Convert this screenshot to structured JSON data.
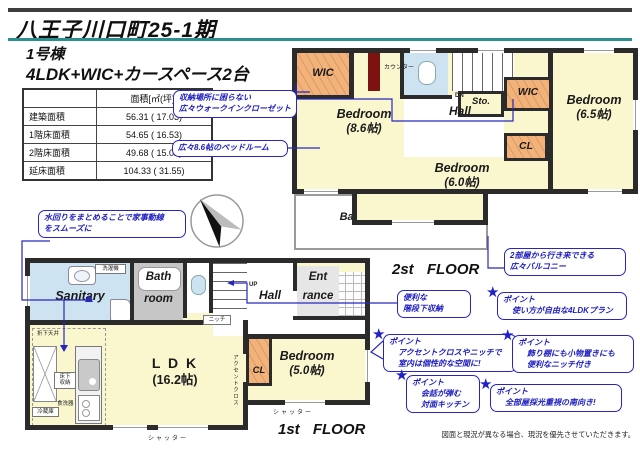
{
  "page": {
    "title": "八王子川口町25-1期",
    "unit": "1号棟",
    "spec": "4LDK+WIC+カースペース2台",
    "disclaimer": "図面と現況が異なる場合、現況を優先させていただきます。"
  },
  "area_table": {
    "corner": "",
    "header": "面積[㎡(坪)]",
    "rows": [
      {
        "label": "建築面積",
        "value": "56.31 ( 17.03)"
      },
      {
        "label": "1階床面積",
        "value": "54.65 ( 16.53)"
      },
      {
        "label": "2階床面積",
        "value": "49.68 ( 15.02)"
      },
      {
        "label": "延床面積",
        "value": "104.33 ( 31.55)"
      }
    ]
  },
  "floor2": {
    "floor_label": "2st FLOOR",
    "rooms": {
      "wic_left": "WIC",
      "wic_right": "WIC",
      "storage": "Sto.",
      "closet": "CL",
      "hall": "Hall",
      "balcony": "Balcony",
      "bedroom_86": {
        "name": "Bedroom",
        "size": "(8.6帖)"
      },
      "bedroom_60": {
        "name": "Bedroom",
        "size": "(6.0帖)"
      },
      "bedroom_65": {
        "name": "Bedroom",
        "size": "(6.5帖)"
      }
    },
    "labels": {
      "counter": "カウンター",
      "down": "DN"
    }
  },
  "floor1": {
    "floor_label": "1st FLOOR",
    "rooms": {
      "sanitary": "Sanitary",
      "bath": {
        "line1": "Bath",
        "line2": "room"
      },
      "hall": "Hall",
      "entrance": {
        "line1": "Ent",
        "line2": "rance"
      },
      "closet": "CL",
      "ldk": {
        "name": "L D K",
        "size": "(16.2帖)"
      },
      "bedroom_50": {
        "name": "Bedroom",
        "size": "(5.0帖)"
      }
    },
    "labels": {
      "washer": "洗濯機",
      "up": "UP",
      "niche": "ニッチ",
      "dropped_ceiling": "折下天井",
      "floor_storage_1": "床下",
      "floor_storage_2": "収納",
      "dishwasher": "食洗器",
      "fridge": "冷蔵庫",
      "accent_cloth": "アクセントクロス",
      "shutter": "シャッター"
    }
  },
  "callouts": [
    {
      "lines": [
        "収納場所に困らない",
        "広々ウォークインクローゼット"
      ]
    },
    {
      "lines": [
        "広々8.6帖のベッドルーム"
      ]
    },
    {
      "lines": [
        "水回りをまとめることで家事動線",
        "をスムーズに"
      ]
    },
    {
      "lines": [
        "2部屋から行き来できる",
        "広々バルコニー"
      ]
    },
    {
      "lines": [
        "便利な",
        "階段下収納"
      ]
    },
    {
      "lines": [
        "ポイント",
        "使い方が自由な4LDKプラン"
      ]
    },
    {
      "lines": [
        "ポイント",
        "アクセントクロスやニッチで",
        "室内は個性的な空間に!"
      ]
    },
    {
      "lines": [
        "ポイント",
        "飾り棚にも小物置きにも",
        "便利なニッチ付き"
      ]
    },
    {
      "lines": [
        "ポイント",
        "会話が弾む",
        "対面キッチン"
      ]
    },
    {
      "lines": [
        "ポイント",
        "全部屋採光重視の南向き!"
      ]
    }
  ],
  "icons": {
    "star": "★"
  },
  "colors": {
    "accent_blue": "#2727bf",
    "wall": "#2b2b2b",
    "room_yellow": "#faf7cf",
    "closet_orange": "#f2b27a",
    "water_blue": "#cee3f2",
    "teal_underline": "#2a8f8f",
    "counter_red": "#7c1212"
  }
}
